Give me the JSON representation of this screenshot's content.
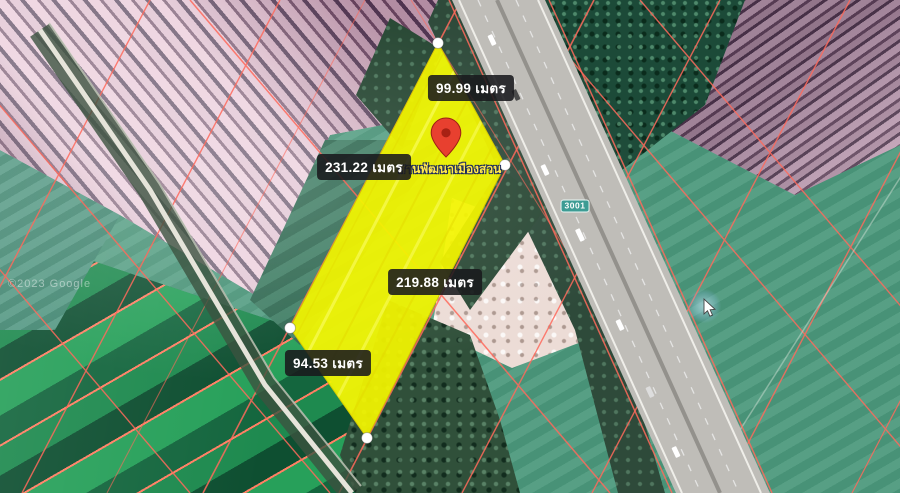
{
  "map": {
    "type": "satellite-land-plot-listing",
    "unit": "เมตร",
    "measurements": [
      {
        "side": "top-edge",
        "value_m": 99.99,
        "text": "99.99 เมตร"
      },
      {
        "side": "left-edge",
        "value_m": 231.22,
        "text": "231.22 เมตร"
      },
      {
        "side": "right-edge",
        "value_m": 219.88,
        "text": "219.88 เมตร"
      },
      {
        "side": "bottom-edge",
        "value_m": 94.53,
        "text": "94.53 เมตร"
      }
    ],
    "pin_caption": "สานพัฒนาเมืองสวน",
    "route_badge": "3001",
    "attribution": "©2023 Google",
    "colors": {
      "plot_fill": "#f3f500",
      "cadastral_line": "#ff6a5c",
      "measurement_label_bg": "#19191c",
      "pin_red": "#e8402f",
      "route_badge_bg": "#3d9c94",
      "field_green": "#27a05a",
      "field_purple": "#d9b6c8"
    }
  }
}
